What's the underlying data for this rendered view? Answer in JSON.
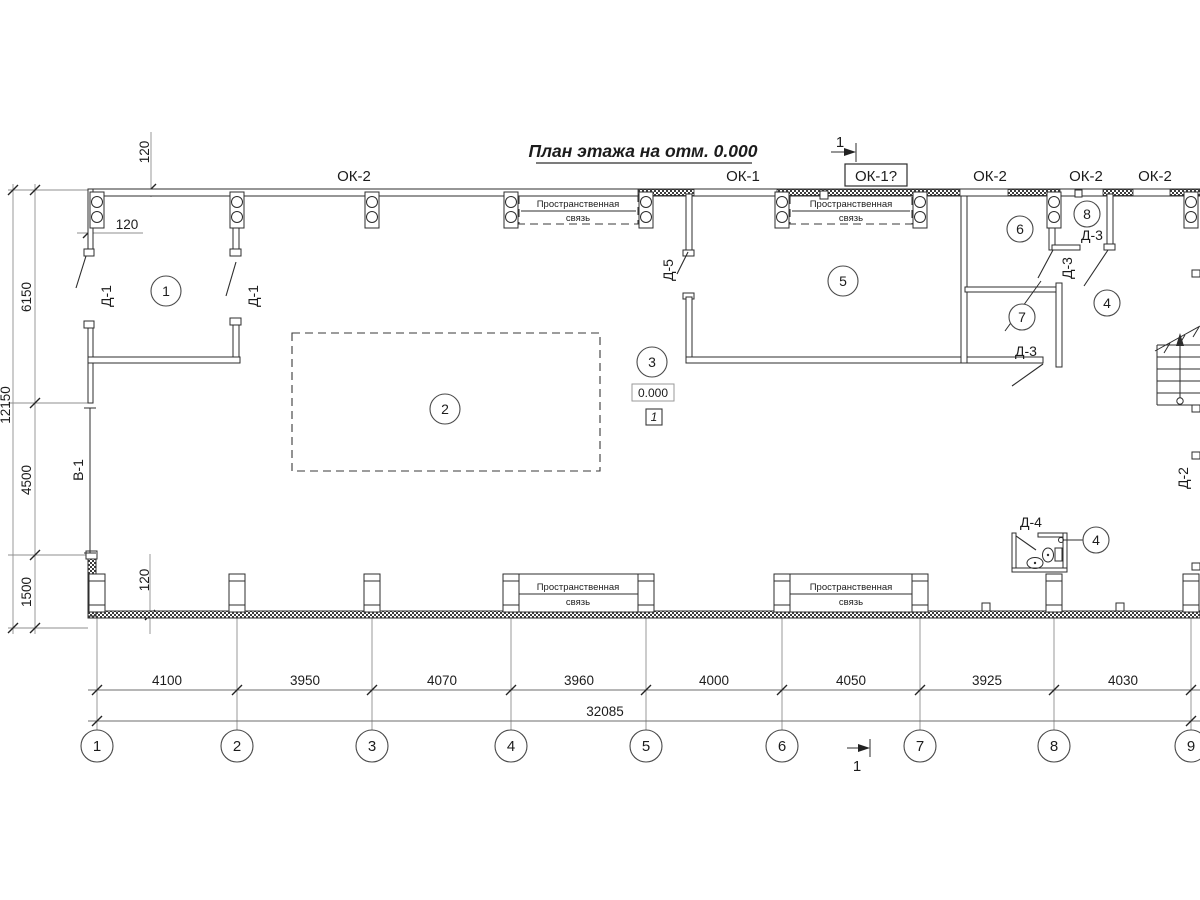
{
  "title": "План этажа на отм. 0.000",
  "section_marker": "1",
  "labels": {
    "ok2": "ОК-2",
    "ok1": "ОК-1",
    "ok1_boxed": "ОК-1?",
    "brace_line1": "Пространственная",
    "brace_line2": "связь",
    "d1": "Д-1",
    "d2": "Д-2",
    "d3": "Д-3",
    "d4": "Д-4",
    "d5": "Д-5",
    "v1": "В-1"
  },
  "rooms": [
    "1",
    "2",
    "3",
    "4",
    "5",
    "6",
    "7",
    "8"
  ],
  "elevation": {
    "value": "0.000",
    "ref": "1"
  },
  "dims": {
    "bottom": [
      "4100",
      "3950",
      "4070",
      "3960",
      "4000",
      "4050",
      "3925",
      "4030"
    ],
    "bottom_total": "32085",
    "left": [
      "6150",
      "4500",
      "1500"
    ],
    "left_total": "12150",
    "offset": "120"
  },
  "axes": [
    "1",
    "2",
    "3",
    "4",
    "5",
    "6",
    "7",
    "8",
    "9"
  ]
}
